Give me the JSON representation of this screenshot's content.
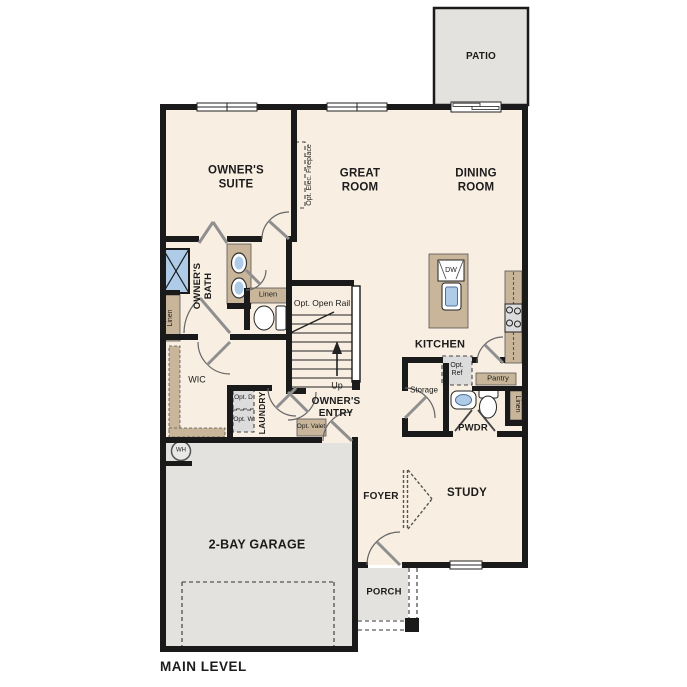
{
  "colors": {
    "floor": "#f8eee1",
    "outdoor_concrete": "#e3e2de",
    "wall": "#1a1a1a",
    "cabinet_tan": "#c8b59a",
    "fixture_blue": "#aecbe8"
  },
  "labels": {
    "patio": "PATIO",
    "owners_suite": "OWNER'S SUITE",
    "great_room": "GREAT ROOM",
    "dining_room": "DINING ROOM",
    "kitchen": "KITCHEN",
    "owners_bath": "OWNER'S BATH",
    "wic": "WIC",
    "laundry": "LAUNDRY",
    "owners_entry": "OWNER'S ENTRY",
    "pwdr": "PWDR",
    "study": "STUDY",
    "foyer": "FOYER",
    "porch": "PORCH",
    "garage": "2-BAY GARAGE",
    "main_level": "MAIN LEVEL",
    "opt_elec_fireplace": "Opt. Elec. Fireplace",
    "opt_open_rail": "Opt. Open Rail",
    "up": "Up",
    "linen_bath": "Linen",
    "linen_hall": "Linen",
    "linen_pwdr": "Linen",
    "opt_d": "Opt. D",
    "opt_w": "Opt. W",
    "opt_valet": "Opt. Valet",
    "opt_ref": "Opt. Ref",
    "pantry": "Pantry",
    "storage": "Storage",
    "dw": "DW",
    "wh": "WH"
  }
}
